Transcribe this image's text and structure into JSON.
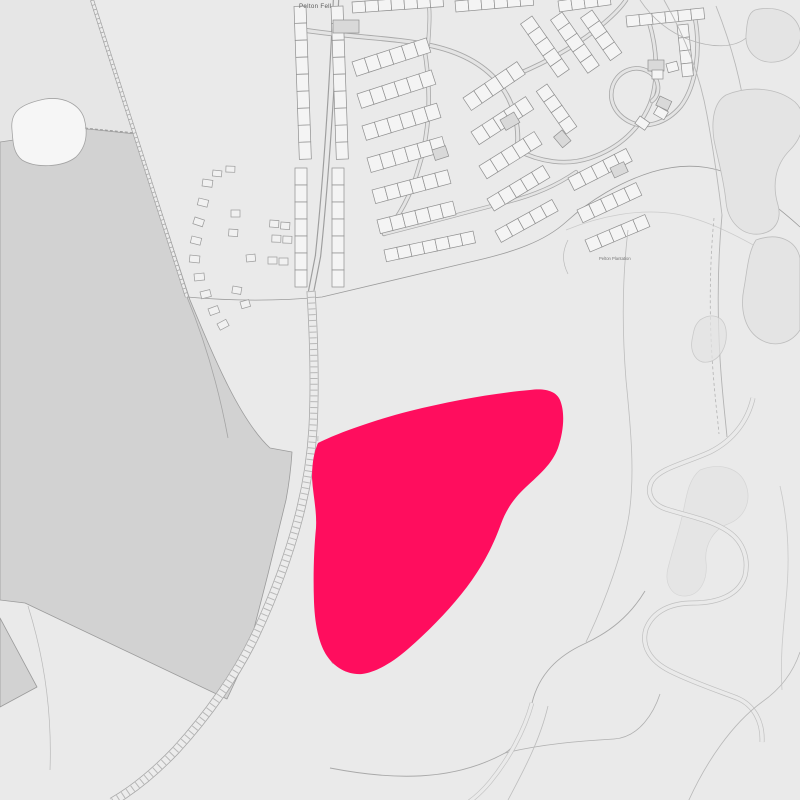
{
  "labels": {
    "place": "Pelton Fell",
    "plantation": "Pelton Plantation"
  },
  "site": {
    "name": "highlighted-site-boundary",
    "color": "#FF0D5E",
    "path": "M318,443 C340,432 375,420 410,411 C450,401 495,393 530,390 C545,388 556,391 560,400 C565,412 564,430 558,448 C552,464 540,474 526,487 C514,498 506,510 501,524 C494,543 486,560 472,580 C455,604 432,628 408,649 C392,663 376,672 362,674 C348,675 335,668 327,656 C319,644 315,626 314,602 C313,575 314,548 316,528 C317,511 313,495 312,478 C312,463 314,452 318,443 Z"
  },
  "colors": {
    "background": "#eaeaea",
    "field_dark": "#d2d2d2",
    "field_light_nw": "#e6e6e6",
    "building_fill": "#f4f4f4",
    "building_dark": "#d9d9d9",
    "building_stroke": "#8f8f8f",
    "road_casing": "#9e9e9e",
    "road_fill": "#e9e9e9",
    "line_faint": "#b5b5b5",
    "label_color": "#5a5a5a"
  },
  "map": {
    "width": 800,
    "height": 800,
    "layers": [
      {
        "t": "rect",
        "name": "map-background",
        "x": 0,
        "y": 0,
        "w": 800,
        "h": 800,
        "f": "#eaeaea"
      },
      {
        "t": "path",
        "name": "nw-light-field",
        "d": "M0,0 L92,0 L136,133 L88,128 L0,141 Z",
        "f": "#e6e6e6",
        "s": "none",
        "w": 0
      },
      {
        "t": "path",
        "name": "dark-field",
        "d": "M0,142 L88,129 L136,134 C154,190 172,245 190,300 C215,360 240,420 270,448 L292,452 C291,468 289,484 286,500 C280,525 274,550 268,574 C261,601 254,629 247,656 L227,699 L25,603 L0,600 Z",
        "f": "#d2d2d2",
        "s": "#9b9b9b",
        "w": 0.8
      },
      {
        "t": "path",
        "name": "dark-field-corner",
        "d": "M0,618 L37,687 L0,707 Z",
        "f": "#d2d2d2",
        "s": "#9b9b9b",
        "w": 0.8
      },
      {
        "t": "path",
        "name": "field-wedge-line",
        "d": "M28,606 C45,660 52,715 50,770",
        "f": "none",
        "s": "#adadad",
        "w": 0.7,
        "o": 0.8
      },
      {
        "t": "path",
        "name": "pond-clearing",
        "d": "M12,130 C10,112 20,104 45,99 C66,96 80,106 84,118 C88,132 87,146 76,157 C62,168 35,168 22,160 C13,153 13,142 12,130 Z",
        "f": "#f6f6f6",
        "s": "#a3a3a3",
        "w": 0.8
      },
      {
        "t": "path",
        "name": "dashed-field-boundary",
        "d": "M85,128 L136,133",
        "f": "none",
        "s": "#979797",
        "w": 0.8,
        "da": "3,2"
      },
      {
        "t": "path",
        "name": "diagonal-path-casing",
        "d": "M92,0 C125,105 158,205 187,297",
        "f": "none",
        "s": "#a2a2a2",
        "w": 4
      },
      {
        "t": "path",
        "name": "diagonal-path-fill",
        "d": "M92,0 C125,105 158,205 187,297",
        "f": "none",
        "s": "#ececec",
        "w": 2.6
      },
      {
        "t": "path",
        "name": "diagonal-path-ticks",
        "d": "M92,0 C125,105 158,205 187,297",
        "f": "none",
        "s": "#a8a8a8",
        "w": 4,
        "da": "0.8,4"
      },
      {
        "t": "path",
        "name": "estate-south-boundary",
        "d": "M187,297 C232,301 280,301 322,297 L470,262 C515,252 545,241 566,222 C590,200 620,182 652,172 C692,160 724,168 745,183 C768,200 786,214 800,227",
        "f": "none",
        "s": "#9c9c9c",
        "w": 0.8
      },
      {
        "t": "path",
        "name": "open-land-boundary",
        "d": "M566,230 C600,216 640,208 676,214 C710,220 750,242 782,262 C792,268 797,272 800,275",
        "f": "none",
        "s": "#b5b5b5",
        "w": 0.7,
        "o": 0.6
      },
      {
        "t": "path",
        "name": "caravan-field-boundary",
        "d": "M187,297 C208,348 220,395 228,438",
        "f": "none",
        "s": "#a5a5a5",
        "w": 0.8
      },
      {
        "t": "road",
        "name": "main-road",
        "d": "M336,0 C332,85 327,170 318,256 L311,292",
        "w": 6.5,
        "c1": "#9e9e9e",
        "c2": "#e9e9e9"
      },
      {
        "t": "road",
        "name": "estate-street-1",
        "d": "M303,30 C348,37 395,38 428,45 C458,51 482,63 498,82 C514,102 520,126 517,150",
        "w": 5,
        "c1": "#a8a8a8",
        "c2": "#e4e4e4"
      },
      {
        "t": "road",
        "name": "estate-street-2",
        "d": "M424,47 C432,92 430,132 418,170 C410,198 398,218 384,234",
        "w": 4.5,
        "c1": "#a8a8a8",
        "c2": "#e4e4e4"
      },
      {
        "t": "road",
        "name": "estate-street-3",
        "d": "M498,82 C530,70 562,54 586,37 C604,24 618,12 626,0",
        "w": 4.5,
        "c1": "#a8a8a8",
        "c2": "#e4e4e4"
      },
      {
        "t": "road",
        "name": "estate-street-4",
        "d": "M517,150 C540,162 566,166 590,158 C620,148 640,128 650,104 C659,80 657,48 649,22",
        "w": 4.5,
        "c1": "#a8a8a8",
        "c2": "#e4e4e4"
      },
      {
        "t": "road",
        "name": "estate-street-hook",
        "d": "M695,18 C701,50 696,86 681,106 C666,124 644,130 628,121 C614,113 608,99 613,85 C619,70 636,64 649,72 C660,79 661,94 652,101",
        "w": 4.5,
        "c1": "#a8a8a8",
        "c2": "#e4e4e4"
      },
      {
        "t": "road",
        "name": "estate-street-5",
        "d": "M384,234 C424,224 464,213 503,203 C533,196 556,186 576,172",
        "w": 4,
        "c1": "#a8a8a8",
        "c2": "#e4e4e4"
      },
      {
        "t": "road",
        "name": "estate-street-6",
        "d": "M428,45 C430,20 430,8 428,0",
        "w": 4,
        "c1": "#a8a8a8",
        "c2": "#e4e4e4"
      },
      {
        "t": "rowset",
        "name": "terrace-row",
        "f": "#f4f4f4",
        "s": "#8f8f8f",
        "w": 0.7,
        "rows": [
          [
            306,
            6,
            88,
            9,
            17,
            12
          ],
          [
            307,
            168,
            90,
            7,
            17,
            12
          ],
          [
            343,
            6,
            88,
            9,
            17,
            12
          ],
          [
            344,
            168,
            90,
            7,
            17,
            12
          ],
          [
            352,
            62,
            -18,
            6,
            13,
            15
          ],
          [
            357,
            94,
            -18,
            6,
            13,
            15
          ],
          [
            362,
            126,
            -17,
            6,
            13,
            15
          ],
          [
            367,
            158,
            -16,
            6,
            13,
            15
          ],
          [
            372,
            190,
            -15,
            6,
            13,
            14
          ],
          [
            377,
            220,
            -14,
            6,
            13,
            14
          ],
          [
            384,
            250,
            -12,
            7,
            13,
            12
          ],
          [
            463,
            98,
            -34,
            5,
            13,
            15
          ],
          [
            471,
            132,
            -33,
            5,
            13,
            15
          ],
          [
            479,
            166,
            -32,
            5,
            13,
            15
          ],
          [
            487,
            199,
            -31,
            5,
            13,
            14
          ],
          [
            495,
            231,
            -29,
            5,
            13,
            13
          ],
          [
            532,
            16,
            55,
            5,
            13,
            14
          ],
          [
            562,
            12,
            55,
            5,
            13,
            14
          ],
          [
            592,
            10,
            55,
            4,
            13,
            14
          ],
          [
            547,
            84,
            55,
            4,
            13,
            13
          ],
          [
            568,
            178,
            -27,
            5,
            13,
            14
          ],
          [
            577,
            210,
            -25,
            5,
            13,
            14
          ],
          [
            585,
            240,
            -23,
            5,
            13,
            13
          ],
          [
            352,
            2,
            -4,
            7,
            13,
            11
          ],
          [
            455,
            1,
            -5,
            6,
            13,
            11
          ],
          [
            558,
            1,
            -8,
            4,
            13,
            11
          ],
          [
            626,
            16,
            -6,
            6,
            13,
            11
          ],
          [
            688,
            24,
            84,
            4,
            13,
            11
          ]
        ]
      },
      {
        "t": "rects",
        "name": "dark-building",
        "f": "#d9d9d9",
        "s": "#8f8f8f",
        "w": 0.7,
        "items": [
          [
            333,
            20,
            26,
            13,
            0
          ],
          [
            500,
            120,
            16,
            12,
            -30
          ],
          [
            432,
            150,
            14,
            11,
            -18
          ],
          [
            562,
            130,
            14,
            11,
            50
          ],
          [
            610,
            168,
            15,
            11,
            -25
          ],
          [
            648,
            60,
            16,
            11,
            0
          ],
          [
            660,
            96,
            13,
            10,
            25
          ]
        ]
      },
      {
        "t": "rects",
        "name": "detached-building",
        "f": "#f4f4f4",
        "s": "#8f8f8f",
        "w": 0.7,
        "items": [
          [
            652,
            70,
            11,
            9,
            0
          ],
          [
            666,
            64,
            11,
            9,
            -15
          ],
          [
            640,
            116,
            12,
            9,
            35
          ],
          [
            658,
            106,
            12,
            9,
            30
          ]
        ]
      },
      {
        "t": "rects",
        "name": "caravan",
        "f": "#f1f1f1",
        "s": "#9a9a9a",
        "w": 0.7,
        "items": [
          [
            203,
            179,
            10,
            7,
            8
          ],
          [
            199,
            198,
            10,
            7,
            14
          ],
          [
            195,
            217,
            10,
            7,
            18
          ],
          [
            192,
            236,
            10,
            7,
            14
          ],
          [
            190,
            255,
            10,
            7,
            6
          ],
          [
            194,
            274,
            10,
            7,
            -6
          ],
          [
            200,
            292,
            10,
            7,
            -14
          ],
          [
            208,
            309,
            10,
            7,
            -20
          ],
          [
            217,
            324,
            10,
            7,
            -28
          ],
          [
            213,
            170,
            9,
            6,
            6
          ],
          [
            226,
            166,
            9,
            6,
            2
          ],
          [
            231,
            210,
            9,
            7,
            0
          ],
          [
            229,
            229,
            9,
            7,
            4
          ],
          [
            246,
            255,
            9,
            7,
            -6
          ],
          [
            233,
            286,
            9,
            7,
            10
          ],
          [
            240,
            302,
            9,
            7,
            -16
          ],
          [
            270,
            220,
            9,
            7,
            4
          ],
          [
            281,
            222,
            9,
            7,
            4
          ],
          [
            272,
            235,
            9,
            7,
            2
          ],
          [
            283,
            236,
            9,
            7,
            2
          ],
          [
            268,
            257,
            9,
            7,
            0
          ],
          [
            279,
            258,
            9,
            7,
            0
          ]
        ]
      },
      {
        "t": "path",
        "name": "railway-track-casing",
        "d": "M311,291 C314,340 315,390 313,428 C311,462 306,490 298,520 C288,558 273,598 254,638 C236,675 208,715 176,750 C154,773 133,790 112,802",
        "f": "none",
        "s": "#a9a9a9",
        "w": 9
      },
      {
        "t": "path",
        "name": "railway-track-fill",
        "d": "M311,291 C314,340 315,390 313,428 C311,462 306,490 298,520 C288,558 273,598 254,638 C236,675 208,715 176,750 C154,773 133,790 112,802",
        "f": "none",
        "s": "#ececec",
        "w": 7.4
      },
      {
        "t": "path",
        "name": "railway-track-hatching",
        "d": "M311,291 C314,340 315,390 313,428 C311,462 306,490 298,520 C288,558 273,598 254,638 C236,675 208,715 176,750 C154,773 133,790 112,802",
        "f": "none",
        "s": "#b3b3b3",
        "w": 7,
        "da": "1,4.8",
        "o": 0.9
      },
      {
        "t": "path",
        "name": "track-side-dashes",
        "d": "M318,436 C316,480 316,525 318,565 C319,600 324,640 333,665",
        "f": "none",
        "s": "#b0b0b0",
        "w": 0.9,
        "da": "5,3",
        "o": 0.8
      },
      {
        "t": "path",
        "name": "ne-ribbon-line-1",
        "d": "M664,0 C684,35 700,75 707,115 C713,148 718,182 722,215",
        "f": "none",
        "s": "#b8b8b8",
        "w": 0.9
      },
      {
        "t": "path",
        "name": "ne-ribbon-line-2",
        "d": "M716,6 C731,44 742,84 746,120 C749,150 748,185 741,215",
        "f": "none",
        "s": "#b8b8b8",
        "w": 0.9
      },
      {
        "t": "path",
        "name": "ne-corner-line",
        "d": "M640,0 C652,18 668,32 690,40 C712,48 734,48 746,38",
        "f": "none",
        "s": "#b5b5b5",
        "w": 0.8
      },
      {
        "t": "path",
        "name": "east-path-solid",
        "d": "M722,215 C718,258 717,308 720,358 C722,392 725,415 727,437",
        "f": "none",
        "s": "#b3b3b3",
        "w": 0.9
      },
      {
        "t": "path",
        "name": "east-path-dashed",
        "d": "M714,218 C710,260 709,308 712,356 C714,390 717,412 719,434",
        "f": "none",
        "s": "#b3b3b3",
        "w": 0.8,
        "da": "3,2.5"
      },
      {
        "t": "path",
        "name": "scrub-patch-1",
        "d": "M755,10 C775,5 795,12 800,30 C803,45 793,60 775,62 C758,64 745,52 746,35 C747,22 748,13 755,10 Z",
        "f": "#e4e4e4",
        "s": "#bdbdbd",
        "w": 0.8
      },
      {
        "t": "path",
        "name": "scrub-patch-2",
        "d": "M726,95 C750,85 778,88 795,102 C808,114 804,136 790,150 C775,165 772,185 778,205 C782,220 775,232 760,234 C742,236 728,222 726,202 C724,180 718,160 714,140 C711,120 714,102 726,95 Z",
        "f": "#e4e4e4",
        "s": "#bdbdbd",
        "w": 0.8
      },
      {
        "t": "path",
        "name": "scrub-patch-3",
        "d": "M756,240 C778,232 796,240 800,258 L800,330 C790,345 772,348 758,338 C744,328 740,308 744,288 C747,272 748,252 756,240 Z",
        "f": "#e4e4e4",
        "s": "#bdbdbd",
        "w": 0.8
      },
      {
        "t": "path",
        "name": "scrub-patch-4",
        "d": "M700,320 C712,312 724,316 726,330 C728,346 720,360 708,362 C696,364 690,352 692,340 C694,330 694,326 700,320 Z",
        "f": "#e4e4e4",
        "s": "#bdbdbd",
        "w": 0.8,
        "o": 0.7
      },
      {
        "t": "path",
        "name": "scrub-patch-5",
        "d": "M700,470 C720,462 740,468 746,485 C752,502 744,518 728,524 C714,529 704,545 706,562 C708,580 700,595 686,596 C672,597 664,584 668,568 C673,548 680,528 684,508 C687,492 690,478 700,470 Z",
        "f": "#e2e2e2",
        "s": "#c4c4c4",
        "w": 0.7,
        "o": 0.55
      },
      {
        "t": "path",
        "name": "stream-s-bend-casing",
        "d": "M753,398 C748,420 734,440 710,452 C686,463 660,468 652,481 C646,492 651,504 666,509 C688,516 712,520 729,532 C743,542 749,558 745,576 C739,595 718,603 693,603 C671,603 653,611 646,629 C641,646 650,661 670,671 C692,682 716,690 737,698 C754,705 763,722 762,742",
        "f": "none",
        "s": "#c0c0c0",
        "w": 5
      },
      {
        "t": "path",
        "name": "stream-s-bend-fill",
        "d": "M753,398 C748,420 734,440 710,452 C686,463 660,468 652,481 C646,492 651,504 666,509 C688,516 712,520 729,532 C743,542 749,558 745,576 C739,595 718,603 693,603 C671,603 653,611 646,629 C641,646 650,661 670,671 C692,682 716,690 737,698 C754,705 763,722 762,742",
        "f": "none",
        "s": "#eaeaea",
        "w": 3.6
      },
      {
        "t": "path",
        "name": "west-contour-line",
        "d": "M628,230 C622,280 622,330 626,380 C631,430 635,475 629,515 C623,552 606,600 586,642",
        "f": "none",
        "s": "#bdbdbd",
        "w": 0.8
      },
      {
        "t": "path",
        "name": "small-contour-mark",
        "d": "M568,240 C562,252 562,262 568,274",
        "f": "none",
        "s": "#bbbbbb",
        "w": 0.7
      },
      {
        "t": "path",
        "name": "south-boundary-line-1",
        "d": "M330,768 C392,780 452,782 505,753 C520,744 528,722 532,703 C539,674 558,656 584,644 C610,632 630,616 645,591",
        "f": "none",
        "s": "#a9a9a9",
        "w": 0.9
      },
      {
        "t": "path",
        "name": "south-boundary-line-2",
        "d": "M505,753 C542,744 580,741 614,739 C640,737 654,712 660,694",
        "f": "none",
        "s": "#b0b0b0",
        "w": 0.8
      },
      {
        "t": "path",
        "name": "south-stream-casing",
        "d": "M532,703 C524,732 508,760 490,782 C480,794 472,800 466,804",
        "f": "none",
        "s": "#c2c2c2",
        "w": 4.5
      },
      {
        "t": "path",
        "name": "south-stream-fill",
        "d": "M532,703 C524,732 508,760 490,782 C480,794 472,800 466,804",
        "f": "none",
        "s": "#eaeaea",
        "w": 3.2
      },
      {
        "t": "path",
        "name": "south-stream-edge",
        "d": "M548,706 C540,740 524,770 508,800",
        "f": "none",
        "s": "#bdbdbd",
        "w": 0.8
      },
      {
        "t": "path",
        "name": "se-corner-line",
        "d": "M688,802 C706,762 732,724 762,702 C782,688 794,670 800,652",
        "f": "none",
        "s": "#b8b8b8",
        "w": 0.8
      },
      {
        "t": "path",
        "name": "east-edge-line",
        "d": "M780,486 C788,520 790,560 786,600 C783,632 780,660 782,690",
        "f": "none",
        "s": "#c0c0c0",
        "w": 0.8,
        "o": 0.8
      }
    ]
  }
}
